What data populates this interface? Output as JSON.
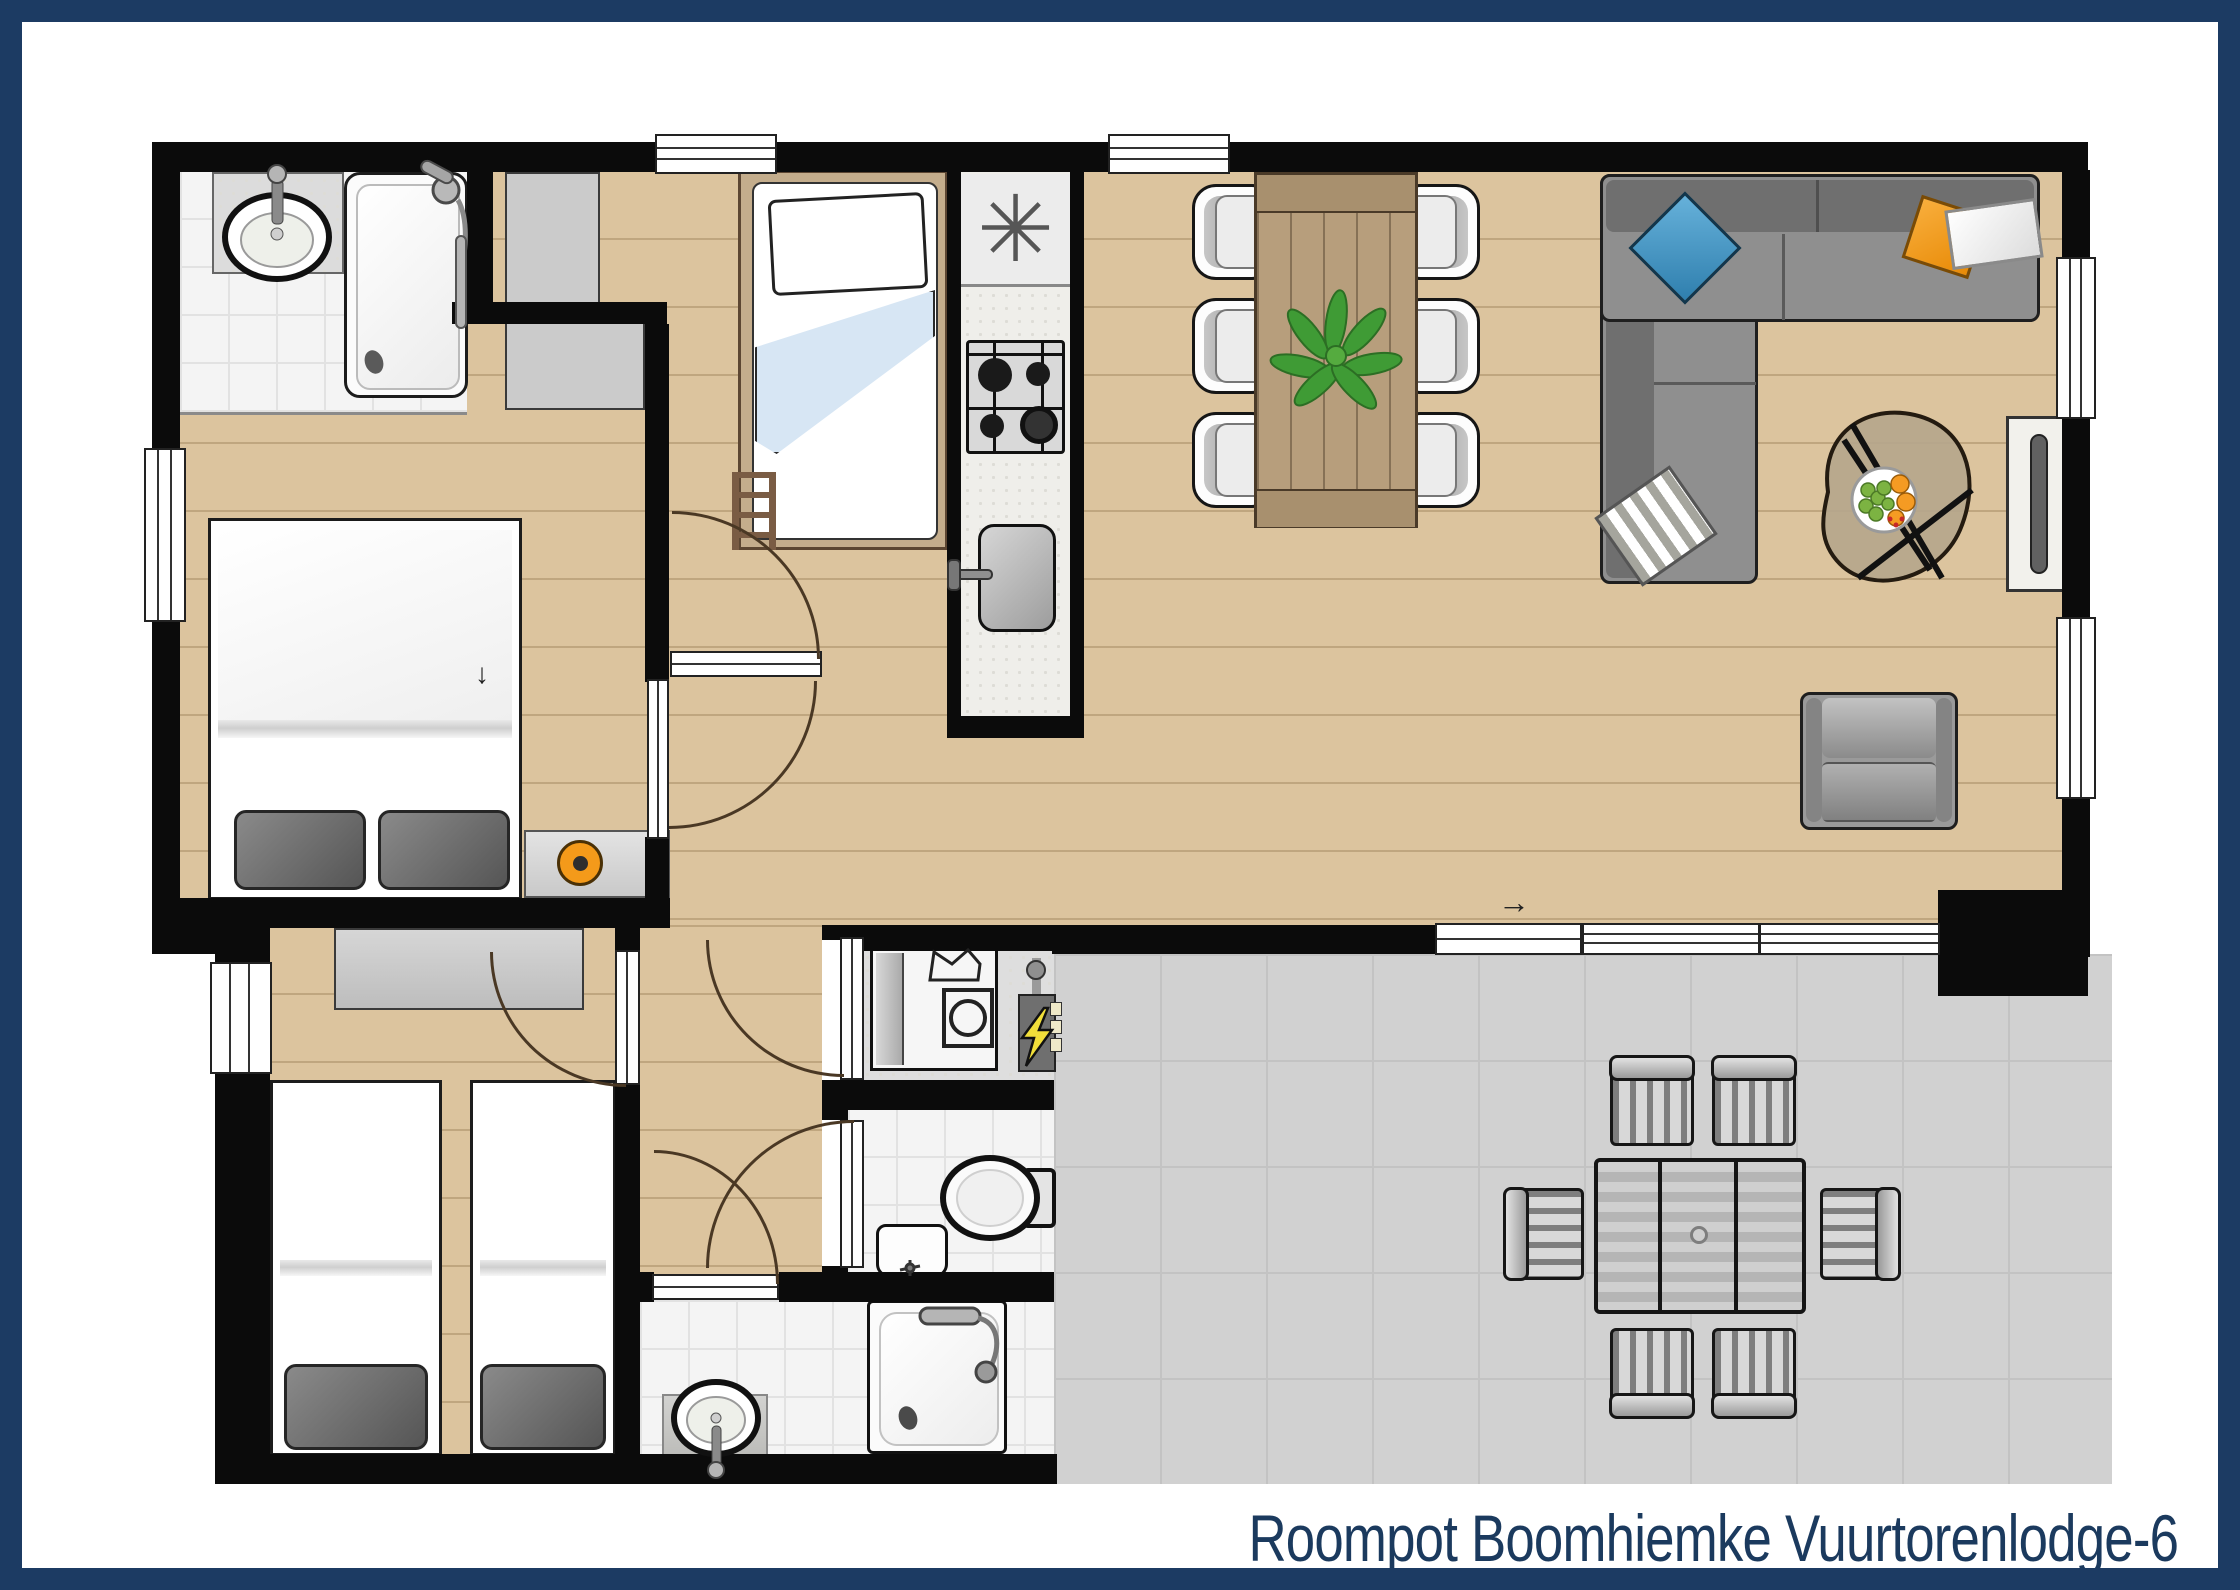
{
  "title": {
    "text": "Roompot Boomhiemke Vuurtorenlodge-6"
  },
  "symbols": {
    "ventilation_asterisk": "✳",
    "entrance_arrow": "→",
    "hall_arrow": "↓"
  },
  "palette": {
    "frame_navy": "#1c3b63",
    "wall_black": "#0b0b0b",
    "wood_floor": "#dcc49e",
    "tile_floor": "#f4f4f4",
    "terrace_gray": "#d1d1d1",
    "dining_table_wood": "#b79e7c",
    "sofa_gray": "#8f8f8f",
    "pillow_blue": "#3d95c8",
    "pillow_orange": "#f49a14",
    "nightstand_ring_orange": "#f49a1a",
    "plant_green": "#3f9b35",
    "lightning_yellow": "#f2df3a",
    "duvet_blue": "#d7e6f4"
  }
}
